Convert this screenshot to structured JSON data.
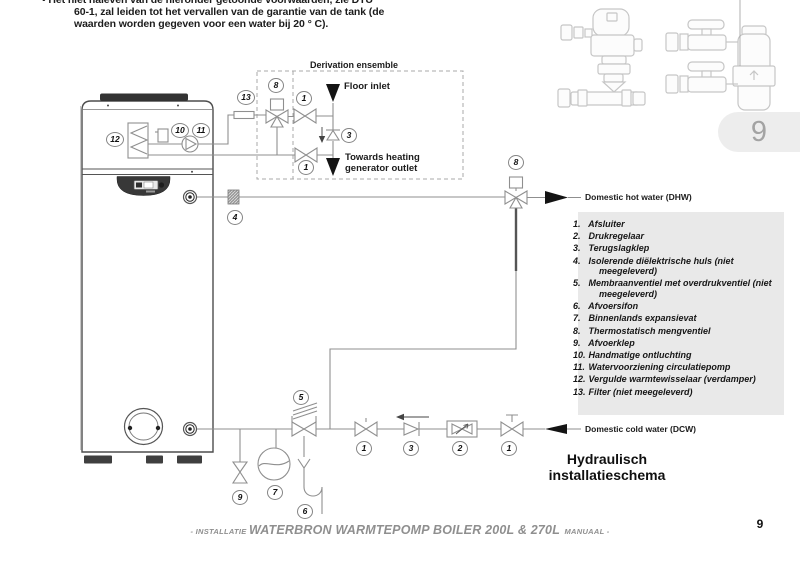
{
  "warning": {
    "line1": "• Het niet naleven van de hieronder getoonde voorwaarden, zie DTU",
    "line2": "60-1, zal leiden tot het vervallen van de garantie van de tank (de",
    "line3": "waarden worden gegeven voor een water bij 20 ° C)."
  },
  "diagram": {
    "labels": {
      "derivation_ensemble": "Derivation ensemble",
      "floor_inlet": "Floor inlet",
      "towards_heating_1": "Towards heating",
      "towards_heating_2": "generator outlet",
      "dhw": "Domestic hot water (DHW)",
      "dcw": "Domestic cold water (DCW)"
    },
    "markers": [
      "13",
      "8",
      "1",
      "3",
      "1",
      "12",
      "10",
      "11",
      "4",
      "8",
      "5",
      "9",
      "7",
      "6",
      "1",
      "3",
      "2",
      "1"
    ]
  },
  "legend": {
    "items": [
      {
        "num": "1.",
        "text": "Afsluiter"
      },
      {
        "num": "2.",
        "text": "Drukregelaar"
      },
      {
        "num": "3.",
        "text": "Terugslagklep"
      },
      {
        "num": "4.",
        "text": "Isolerende diëlektrische huls (niet meegeleverd)"
      },
      {
        "num": "5.",
        "text": "Membraanventiel met overdrukventiel (niet meegeleverd)"
      },
      {
        "num": "6.",
        "text": "Afvoersifon"
      },
      {
        "num": "7.",
        "text": "Binnenlands expansievat"
      },
      {
        "num": "8.",
        "text": "Thermostatisch mengventiel"
      },
      {
        "num": "9.",
        "text": "Afvoerklep"
      },
      {
        "num": "10.",
        "text": "Handmatige ontluchting"
      },
      {
        "num": "11.",
        "text": "Watervoorziening circulatiepomp"
      },
      {
        "num": "12.",
        "text": "Vergulde warmtewisselaar (verdamper)"
      },
      {
        "num": "13.",
        "text": "Filter (niet meegeleverd)"
      }
    ]
  },
  "schema_title": {
    "line1": "Hydraulisch",
    "line2": "installatieschema"
  },
  "footer": {
    "prefix": "- INSTALLATIE ",
    "main": "WATERBRON WARMTEPOMP BOILER 200L & 270L",
    "suffix": " MANUAAL -",
    "page_number": "9"
  },
  "chapter_tab": {
    "number": "9"
  }
}
